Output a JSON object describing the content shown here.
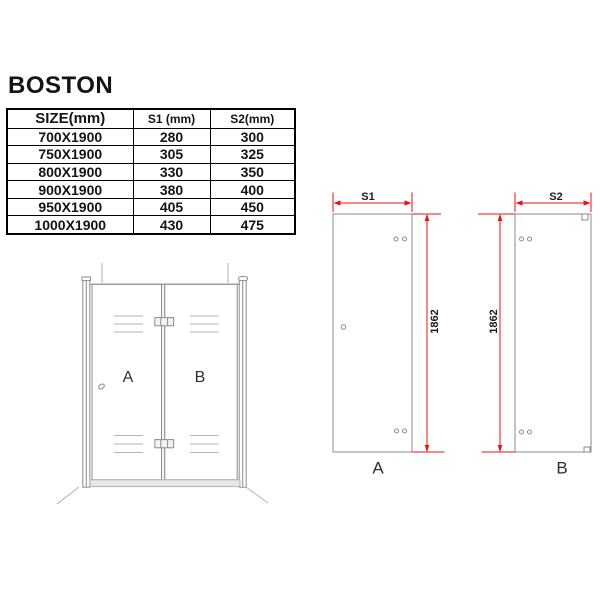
{
  "page": {
    "title": "BOSTON"
  },
  "table": {
    "headers": [
      "SIZE(mm)",
      "S1 (mm)",
      "S2(mm)"
    ],
    "rows": [
      [
        "700X1900",
        "280",
        "300"
      ],
      [
        "750X1900",
        "305",
        "325"
      ],
      [
        "800X1900",
        "330",
        "350"
      ],
      [
        "900X1900",
        "380",
        "400"
      ],
      [
        "950X1900",
        "405",
        "450"
      ],
      [
        "1000X1900",
        "430",
        "475"
      ]
    ]
  },
  "front_view": {
    "panel_a_label": "A",
    "panel_b_label": "B"
  },
  "panel_a_view": {
    "label": "A",
    "width_dim_label": "S1",
    "height_dim_label": "1862"
  },
  "panel_b_view": {
    "label": "B",
    "width_dim_label": "S2",
    "height_dim_label": "1862"
  },
  "colors": {
    "dimension_red": "#ee1010",
    "outline_gray": "#8b8b93",
    "light_gray": "#b2b2b8",
    "text": "#141414"
  }
}
